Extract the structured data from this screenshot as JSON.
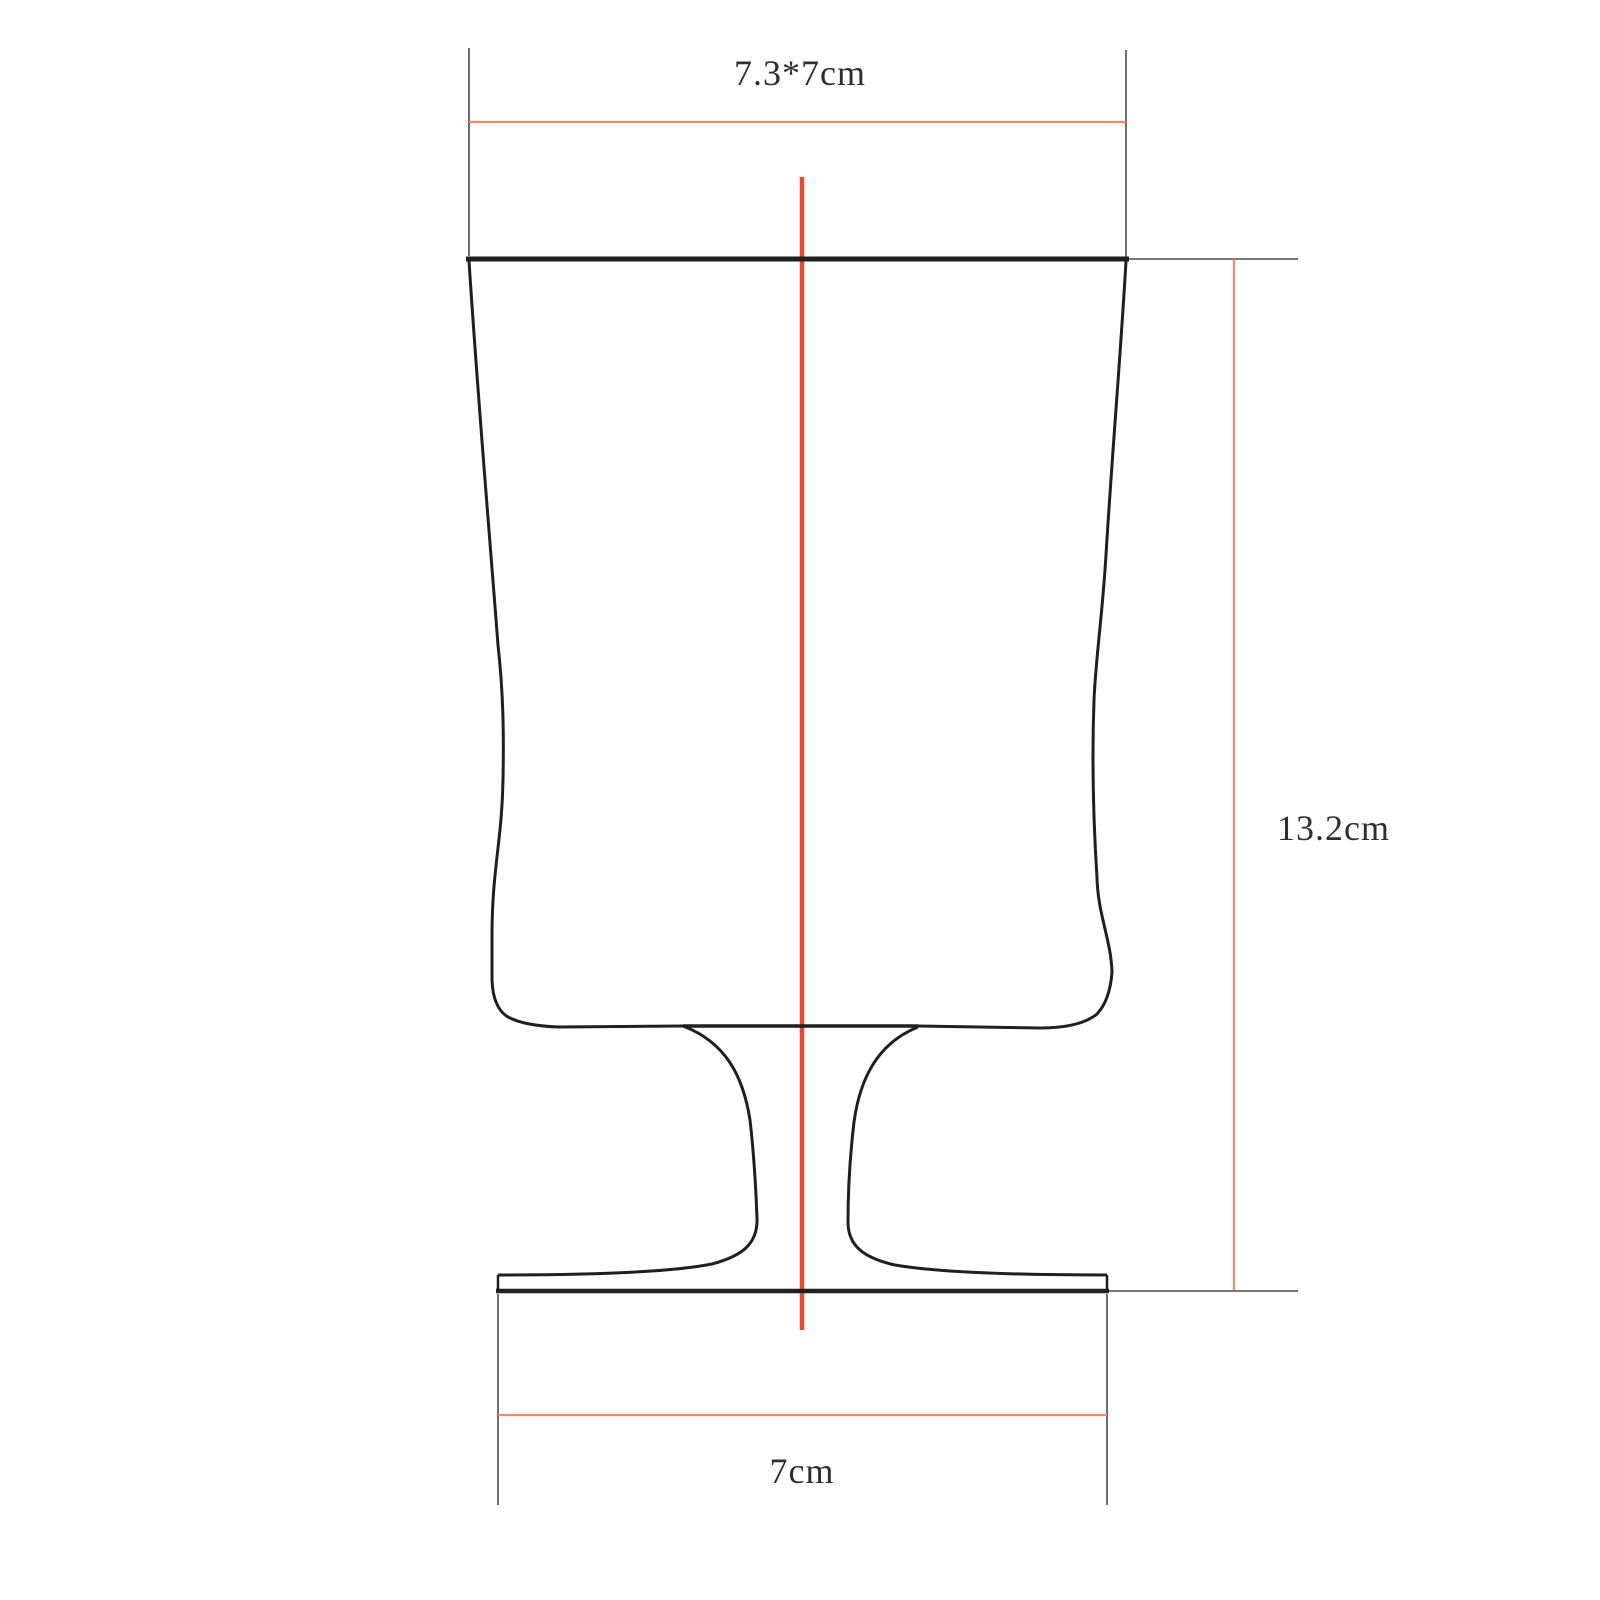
{
  "drawing": {
    "labels": {
      "top_width": "7.3*7cm",
      "height": "13.2cm",
      "base_width": "7cm"
    },
    "colors": {
      "background": "#ffffff",
      "outline": "#1f1f1f",
      "extension_line": "#4a4a4a",
      "dimension_line": "#ed8a63",
      "centerline": "#e64b2e",
      "text": "#2f2f2f"
    }
  }
}
